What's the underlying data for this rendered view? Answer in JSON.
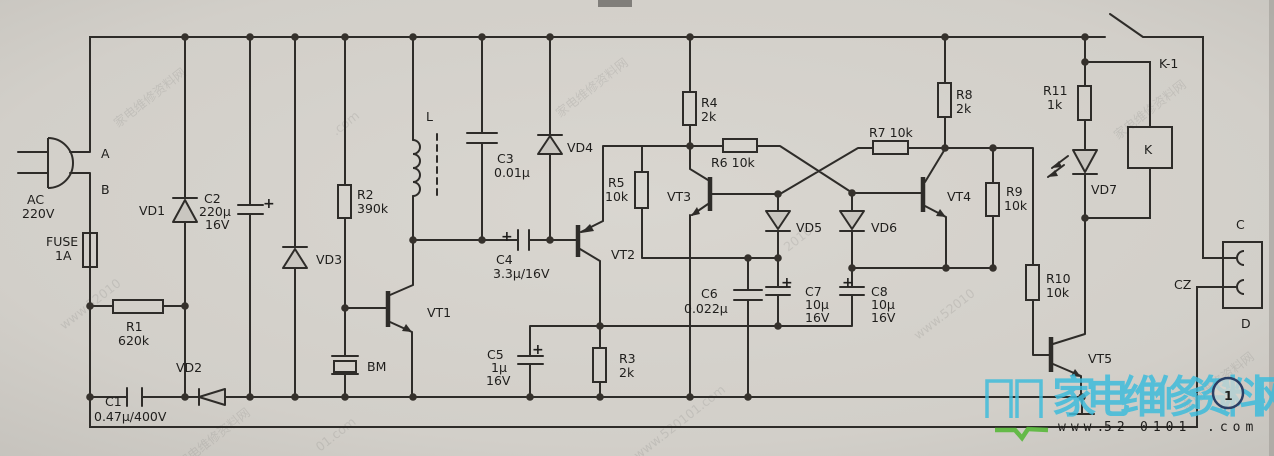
{
  "colors": {
    "paper": "#d2cfc9",
    "line": "#2e2c29",
    "logo_cyan": "#3fbcdb",
    "logo_red": "#c23b2e",
    "logo_gray": "#9b9893",
    "logo_dark": "#4a4643",
    "logo_green": "#58b83a",
    "badge_navy": "#2b3f66"
  },
  "labels": {
    "plug": {
      "a": "A",
      "b": "B",
      "ac": "AC",
      "voltage": "220V"
    },
    "fuse": {
      "name": "FUSE",
      "rating": "1A"
    },
    "r1": {
      "name": "R1",
      "value": "620k"
    },
    "r2": {
      "name": "R2",
      "value": "390k"
    },
    "r3": {
      "name": "R3",
      "value": "2k"
    },
    "r4": {
      "name": "R4",
      "value": "2k"
    },
    "r5": {
      "name": "R5",
      "value": "10k"
    },
    "r6": {
      "name": "R6 10k"
    },
    "r7": {
      "name": "R7 10k"
    },
    "r8": {
      "name": "R8",
      "value": "2k"
    },
    "r9": {
      "name": "R9",
      "value": "10k"
    },
    "r10": {
      "name": "R10",
      "value": "10k"
    },
    "r11": {
      "name": "R11",
      "value": "1k"
    },
    "c1": {
      "name": "C1",
      "value": "0.47µ/400V"
    },
    "c2": {
      "name": "C2",
      "v1": "220µ",
      "v2": "16V"
    },
    "c3": {
      "name": "C3",
      "value": "0.01µ"
    },
    "c4": {
      "name": "C4",
      "value": "3.3µ/16V"
    },
    "c5": {
      "name": "C5",
      "v1": "1µ",
      "v2": "16V"
    },
    "c6": {
      "name": "C6",
      "value": "0.022µ"
    },
    "c7": {
      "name": "C7",
      "v1": "10µ",
      "v2": "16V"
    },
    "c8": {
      "name": "C8",
      "v1": "10µ",
      "v2": "16V"
    },
    "diodes": {
      "vd1": "VD1",
      "vd2": "VD2",
      "vd3": "VD3",
      "vd4": "VD4",
      "vd5": "VD5",
      "vd6": "VD6",
      "vd7": "VD7"
    },
    "transistors": {
      "vt1": "VT1",
      "vt2": "VT2",
      "vt3": "VT3",
      "vt4": "VT4",
      "vt5": "VT5"
    },
    "inductor": "L",
    "buzzer": "BM",
    "relay": "K",
    "relay_contact": "K-1",
    "socket": "CZ",
    "socket_c": "C",
    "socket_d": "D",
    "plus": "+"
  },
  "watermark": {
    "site": "家电维修资料网",
    "url": "www.520101.com",
    "url_short": "www.52010",
    "frag_digits": "2010",
    "frag_com": "01.com",
    "frag_dotcom": ".com"
  },
  "logo": {
    "site": "家电维修资料网",
    "badge": "1",
    "url_www": "www.",
    "url_red": "52",
    "url_mid": "0101",
    "url_dot": ".com"
  }
}
